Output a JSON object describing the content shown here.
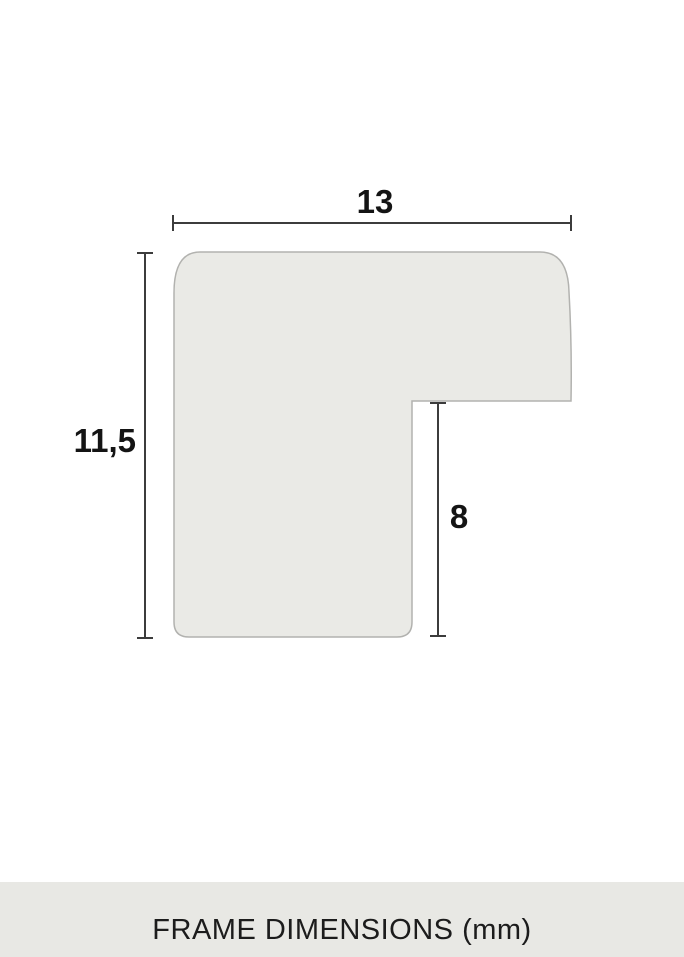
{
  "diagram": {
    "width_mm": "13",
    "height_mm": "11,5",
    "rabbet_mm": "8",
    "colors": {
      "profile_fill": "#EAEAE6",
      "profile_stroke": "#B2B2AF",
      "dimension_line": "#3C3C3C",
      "label_text": "#141414"
    }
  },
  "footer": {
    "caption": "FRAME DIMENSIONS (mm)",
    "background": "#E8E8E4",
    "text_color": "#1C1C1C"
  }
}
